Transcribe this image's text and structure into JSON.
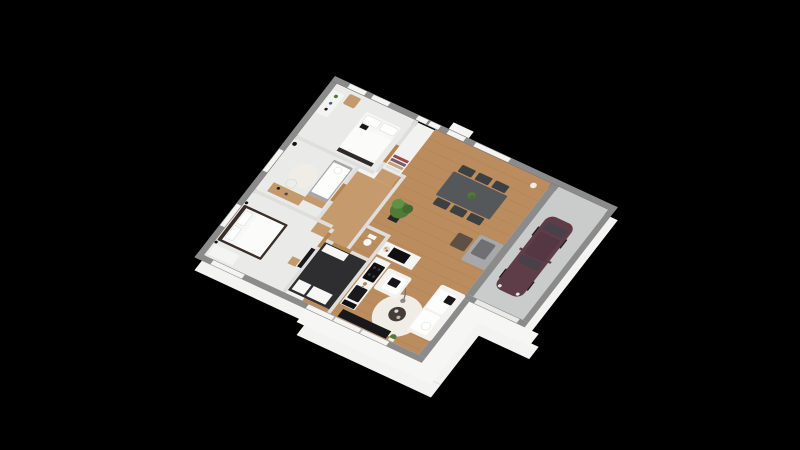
{
  "scene": {
    "description": "3D isometric rendering of a single-storey house floor plan with three bedrooms, bathroom, open kitchen, living-dining room and attached garage, on a black background",
    "background": "#000000"
  },
  "colors": {
    "background": "#000000",
    "exterior": "#f3f3f1",
    "wallTop": "#8b8b8b",
    "wallInner": "#dededc",
    "window": "#f4f4f2",
    "glazingMullion": "#b9b9b7",
    "garageDoor": "#e9e9e7",
    "door": "#b5854f",
    "bedroomFloor": "#eaeae8",
    "wood": "#bb8c5d",
    "woodLight": "#c59b6d",
    "plankLine": "#8a6038",
    "bathFloor": "#2e2e30",
    "garageFloor": "#c9ccca",
    "carBody": "#5e3d49",
    "carGlass": "#494149",
    "carRoof": "#533843",
    "wheel": "#1a1a1c",
    "diningTable": "#54585a",
    "diningChair": "#3c4042",
    "plant": "#4e7c38",
    "plantLight": "#5f9146",
    "plantDark": "#426a2f",
    "plantPot": "#262626",
    "sofaWhite": "#f4f2ee",
    "cushionWhite": "#fdfdfc",
    "cushionBlack": "#17171a",
    "rug": "#efede6",
    "coffeeTable": "#453c3a",
    "tvBench": "#18181a",
    "settee": "#a8a8aa",
    "blanket": "#707074",
    "loungeChair": "#5f4f44",
    "bedFrameDark": "#3a2e29",
    "bedding": "#f7f7f5",
    "duvet": "#fbfbfa",
    "daybedBase": "#a7a7a9",
    "deskWood": "#c49a6c",
    "dresserWhite": "#f4f4f2",
    "applianceBlack": "#101012",
    "counterWhite": "#f4f4f2",
    "closetUnit": "#f2f2f0",
    "closetShelf1": "#9a4a42",
    "closetShelf2": "#7b5a6e",
    "closetShelf3": "#c2a37a",
    "closetShelf4": "#e0e0de",
    "lampShade": "#ececea",
    "fixtureWhite": "#f6f6f4"
  },
  "rooms": [
    {
      "id": "bedroom-1",
      "floor": "light"
    },
    {
      "id": "bedroom-2",
      "floor": "light"
    },
    {
      "id": "bedroom-3",
      "floor": "light"
    },
    {
      "id": "hallway",
      "floor": "wood"
    },
    {
      "id": "wc",
      "floor": "light"
    },
    {
      "id": "bathroom",
      "floor": "dark"
    },
    {
      "id": "kitchen",
      "floor": "wood"
    },
    {
      "id": "living-dining-room",
      "floor": "wood"
    },
    {
      "id": "garage",
      "floor": "concrete"
    }
  ],
  "furnishings": [
    "double-bed",
    "dresser",
    "chair",
    "wardrobe-shelves",
    "daybed",
    "desk",
    "round-rug",
    "dark-double-bed",
    "wall-tv",
    "dining-table",
    "six-dining-chairs",
    "table-plant",
    "tall-potted-plant",
    "kitchen-counter",
    "cooktop",
    "sink",
    "fruit-bowl",
    "sofa",
    "armchair",
    "arc-floor-lamp",
    "coffee-table",
    "tv-bench",
    "bench-with-blanket",
    "washing-machines",
    "toilet",
    "hatchback-car"
  ]
}
